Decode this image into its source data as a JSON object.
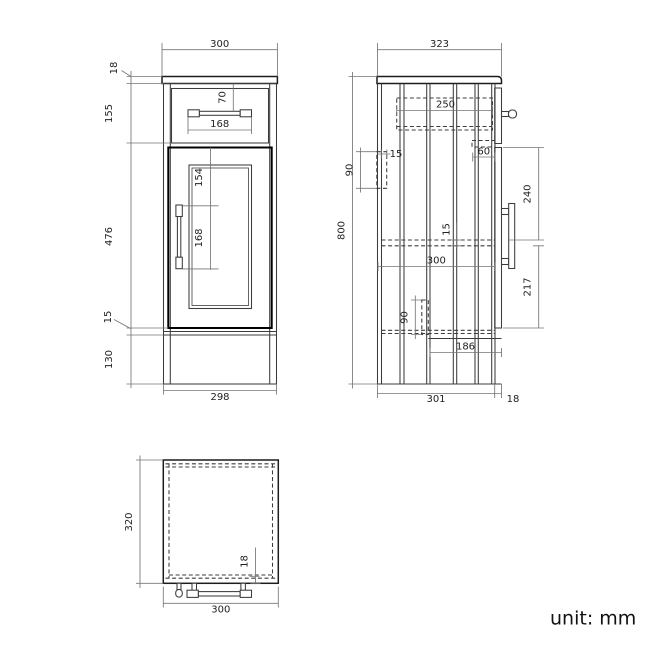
{
  "note": {
    "unit_label": "unit: mm"
  },
  "colors": {
    "line": "#3c3c3c",
    "thick_line": "#000000",
    "dimension_line": "#767676",
    "background": "#ffffff"
  },
  "views": {
    "front": {
      "top_width": "300",
      "worktop_thickness": "18",
      "drawer_section_height": "155",
      "door_height": "476",
      "bottom_gap": "15",
      "plinth_height": "130",
      "drawer_handle_offset": "70",
      "drawer_handle_width": "168",
      "door_handle_offset": "154",
      "door_handle_length": "168",
      "bottom_width": "298"
    },
    "side": {
      "top_depth": "323",
      "overall_height": "800",
      "drawer_depth": "250",
      "wall_bracket_height": "90",
      "wall_bracket_thickness": "15",
      "drawer_runner_length": "60",
      "handle_from_door_top": "240",
      "shelf_thickness": "15",
      "shelf_depth": "300",
      "handle_to_door_bottom": "217",
      "leg_height": "90",
      "leg_offset_from_front": "186",
      "body_depth": "301",
      "door_thickness": "18"
    },
    "top": {
      "depth": "320",
      "door_thickness": "18",
      "width": "300"
    }
  }
}
